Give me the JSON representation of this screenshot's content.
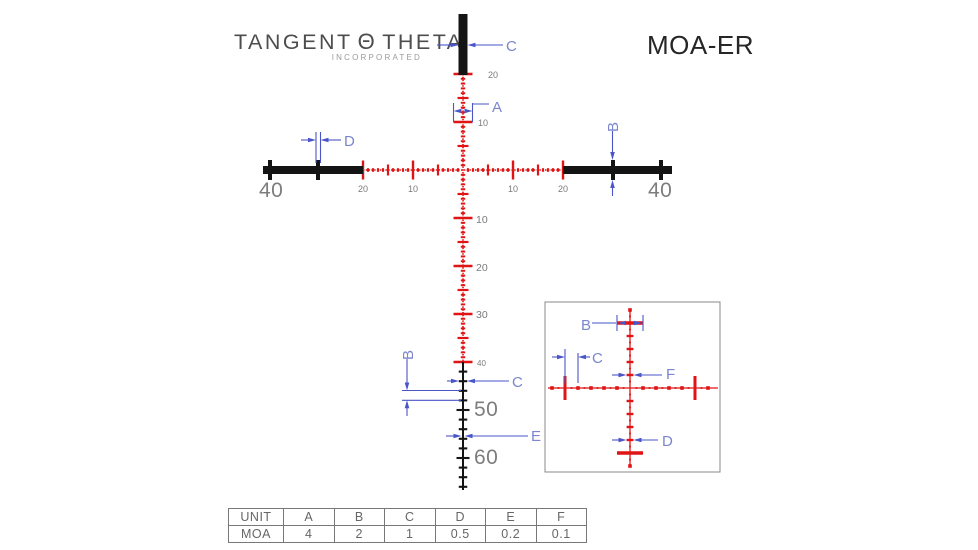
{
  "header": {
    "logo": {
      "word1": "TANGENT",
      "theta": "Θ",
      "word2": "THETA",
      "subtitle": "INCORPORATED"
    },
    "title": "MOA-ER"
  },
  "colors": {
    "red": "#e01414",
    "black": "#141414",
    "blue": "#4a55c8",
    "blue_text": "#7b85cd",
    "gray_text": "#7a7a7a"
  },
  "reticle": {
    "horizontal_left_labels": [
      "20",
      "10"
    ],
    "horizontal_right_labels": [
      "10",
      "20"
    ],
    "vertical_up_labels": [
      "20",
      "10"
    ],
    "vertical_down_labels": [
      "10",
      "20",
      "30",
      "40"
    ],
    "elevation_labels": [
      "50",
      "60"
    ],
    "post_left_label": "40",
    "post_right_label": "40"
  },
  "callouts": {
    "a": "A",
    "b": "B",
    "c": "C",
    "d": "D",
    "e": "E",
    "f": "F"
  },
  "table": {
    "headers": [
      "UNIT",
      "A",
      "B",
      "C",
      "D",
      "E",
      "F"
    ],
    "row_label": "MOA",
    "values": [
      "4",
      "2",
      "1",
      "0.5",
      "0.2",
      "0.1"
    ]
  }
}
